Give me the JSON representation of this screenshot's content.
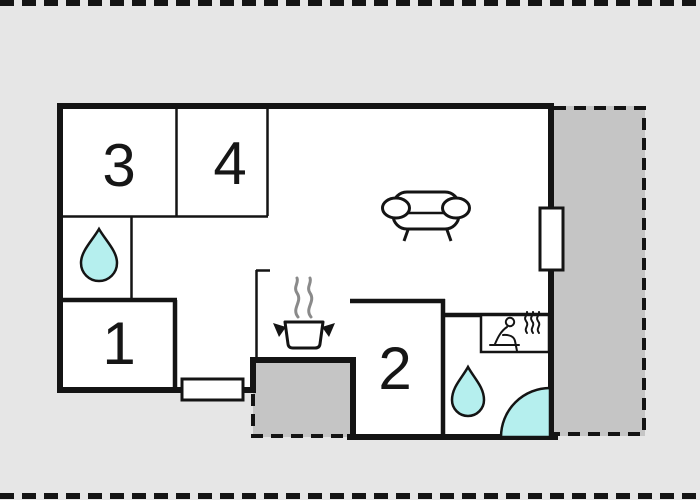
{
  "title": "apartment-floor-plan",
  "rooms": {
    "room3": {
      "label": "3",
      "type": "bedroom"
    },
    "room4": {
      "label": "4",
      "type": "bedroom"
    },
    "room1": {
      "label": "1",
      "type": "bedroom"
    },
    "room2": {
      "label": "2",
      "type": "bedroom"
    }
  },
  "icons": {
    "bathroom_upper": "water-drop-icon",
    "bathroom_lower": "water-drop-icon",
    "living_room": "sofa-icon",
    "kitchen": "cooking-pot-icon",
    "sauna": "sauna-bench-icon",
    "shower": "corner-shower-icon",
    "openings": [
      "entry-door-symbol",
      "terrace-window-symbol"
    ]
  },
  "colors": {
    "background": "#e6e6e6",
    "plan_fill": "#ffffff",
    "wall": "#141414",
    "outdoor_area": "#c5c5c5",
    "water_accent": "#b5efee",
    "steam_gray": "#8a8a8a"
  }
}
